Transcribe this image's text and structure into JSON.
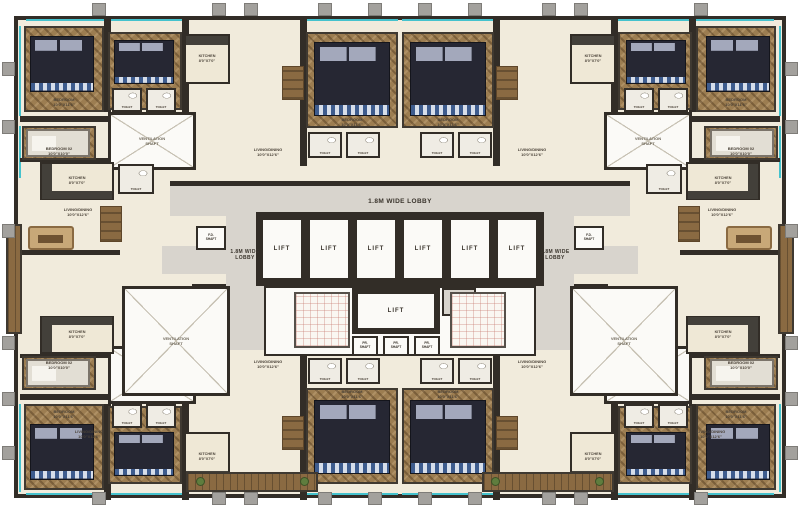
{
  "meta": {
    "type": "architectural-floor-plan",
    "description": "Residential tower typical floor plan with central lift core and apartments on all sides"
  },
  "palette": {
    "background": "#ffffff",
    "floor_cream": "#f1ebdc",
    "lobby_gray": "#d8d4cd",
    "wall_dark": "#322d27",
    "wood_brown": "#9c7d51",
    "bed_navy": "#262733",
    "window_cyan": "#45c2cd",
    "column_gray": "#a3a19d",
    "deck_brown": "#8a6a42"
  },
  "labels": {
    "lift": "LIFT",
    "lobby": "1.8M WIDE LOBBY",
    "fire": "FIRE\nLOBBY",
    "vent": "VENTILATION\nSHAFT",
    "bedroom": "BEDROOM\n10'0\"X11'6\"",
    "bedroom2": "BEDROOM 02\n10'0\"X10'0\"",
    "kitchen": "KITCHEN\n8'0\"X7'0\"",
    "toilet": "TOILET",
    "living": "LIVING/DINING\n10'0\"X12'6\"",
    "fh": "F.H.\nSHAFT",
    "fd": "F.D.\nSHAFT",
    "pr": "PR.\nSHAFT"
  },
  "symmetry": {
    "mirror_x": 400,
    "mirror_y": 258
  },
  "items": [
    {
      "n": "building-footprint",
      "k": "footprint",
      "x": 14,
      "y": 16,
      "w": 772,
      "h": 482
    },
    {
      "n": "window-line",
      "k": "cyan",
      "x": 26,
      "y": 19,
      "w": 78,
      "h": 2,
      "m": "x"
    },
    {
      "n": "window-line",
      "k": "cyan",
      "x": 108,
      "y": 19,
      "w": 74,
      "h": 2,
      "m": "x"
    },
    {
      "n": "window-line",
      "k": "cyan",
      "x": 306,
      "y": 19,
      "w": 92,
      "h": 2,
      "m": "x"
    },
    {
      "n": "window-line",
      "k": "cyan",
      "x": 26,
      "y": 493,
      "w": 78,
      "h": 2,
      "m": "x"
    },
    {
      "n": "window-line",
      "k": "cyan",
      "x": 108,
      "y": 493,
      "w": 74,
      "h": 2,
      "m": "x"
    },
    {
      "n": "window-line",
      "k": "cyan",
      "x": 306,
      "y": 493,
      "w": 92,
      "h": 2,
      "m": "x"
    },
    {
      "n": "window-line",
      "k": "cyan",
      "x": 19,
      "y": 26,
      "w": 2,
      "h": 90,
      "m": "x"
    },
    {
      "n": "window-line",
      "k": "cyan",
      "x": 19,
      "y": 126,
      "w": 2,
      "h": 52,
      "m": "x"
    },
    {
      "n": "window-line",
      "k": "cyan",
      "x": 19,
      "y": 224,
      "w": 2,
      "h": 108,
      "m": "x"
    },
    {
      "n": "window-line",
      "k": "cyan",
      "x": 19,
      "y": 404,
      "w": 2,
      "h": 88,
      "m": "x"
    },
    {
      "n": "lobby-corridor",
      "k": "lobby",
      "x": 170,
      "y": 186,
      "w": 460,
      "h": 30
    },
    {
      "n": "lobby-corridor-left",
      "k": "lobby",
      "x": 226,
      "y": 186,
      "w": 38,
      "h": 164
    },
    {
      "n": "lobby-corridor-right",
      "k": "lobby",
      "x": 536,
      "y": 186,
      "w": 38,
      "h": 164
    },
    {
      "n": "lobby-entry",
      "k": "lobby",
      "x": 162,
      "y": 246,
      "w": 64,
      "h": 28,
      "m": "x"
    },
    {
      "n": "wall",
      "k": "wall",
      "x": 170,
      "y": 181,
      "w": 460,
      "h": 5
    },
    {
      "n": "wall",
      "k": "wall",
      "x": 104,
      "y": 16,
      "w": 7,
      "h": 96,
      "m": "xy"
    },
    {
      "n": "wall",
      "k": "wall",
      "x": 182,
      "y": 16,
      "w": 7,
      "h": 100,
      "m": "xy"
    },
    {
      "n": "wall",
      "k": "wall",
      "x": 300,
      "y": 16,
      "w": 7,
      "h": 150,
      "m": "xy"
    },
    {
      "n": "wall",
      "k": "wall",
      "x": 20,
      "y": 116,
      "w": 160,
      "h": 6,
      "m": "xy"
    },
    {
      "n": "wall",
      "k": "wall",
      "x": 20,
      "y": 158,
      "w": 96,
      "h": 4,
      "m": "xy"
    },
    {
      "n": "wall",
      "k": "wall",
      "x": 20,
      "y": 250,
      "w": 100,
      "h": 5,
      "m": "x"
    },
    {
      "n": "core-hall",
      "k": "whiteroom",
      "x": 264,
      "y": 286,
      "w": 272,
      "h": 70
    },
    {
      "n": "lift-bank-walls",
      "k": "wallblock",
      "x": 256,
      "y": 212,
      "w": 288,
      "h": 74
    },
    {
      "n": "lift-room",
      "k": "liftcell",
      "x": 263,
      "y": 220,
      "w": 38,
      "h": 58,
      "l": "lift"
    },
    {
      "n": "lift-room",
      "k": "liftcell",
      "x": 310,
      "y": 220,
      "w": 38,
      "h": 58,
      "l": "lift"
    },
    {
      "n": "lift-room",
      "k": "liftcell",
      "x": 357,
      "y": 220,
      "w": 38,
      "h": 58,
      "l": "lift"
    },
    {
      "n": "lift-room",
      "k": "liftcell",
      "x": 404,
      "y": 220,
      "w": 38,
      "h": 58,
      "l": "lift"
    },
    {
      "n": "lift-room",
      "k": "liftcell",
      "x": 451,
      "y": 220,
      "w": 38,
      "h": 58,
      "l": "lift"
    },
    {
      "n": "lift-room",
      "k": "liftcell",
      "x": 498,
      "y": 220,
      "w": 38,
      "h": 58,
      "l": "lift"
    },
    {
      "n": "lift-center-walls",
      "k": "wallblock",
      "x": 352,
      "y": 288,
      "w": 88,
      "h": 46
    },
    {
      "n": "lift-room-center",
      "k": "liftcell",
      "x": 358,
      "y": 294,
      "w": 76,
      "h": 34,
      "l": "lift"
    },
    {
      "n": "fire-lobby",
      "k": "smallcell gray",
      "x": 442,
      "y": 288,
      "w": 34,
      "h": 28,
      "l": "fire"
    },
    {
      "n": "pressurization-shaft",
      "k": "smallcell",
      "x": 352,
      "y": 336,
      "w": 26,
      "h": 20,
      "l": "pr"
    },
    {
      "n": "pressurization-shaft",
      "k": "smallcell",
      "x": 383,
      "y": 336,
      "w": 26,
      "h": 20,
      "l": "pr"
    },
    {
      "n": "pressurization-shaft",
      "k": "smallcell",
      "x": 414,
      "y": 336,
      "w": 26,
      "h": 20,
      "l": "pr"
    },
    {
      "n": "staircase",
      "k": "stair",
      "x": 294,
      "y": 292,
      "w": 56,
      "h": 56,
      "m": "x"
    },
    {
      "n": "fd-shaft",
      "k": "smallcell",
      "x": 196,
      "y": 226,
      "w": 30,
      "h": 24,
      "l": "fd",
      "m": "x"
    },
    {
      "n": "fh-shaft",
      "k": "smallcell",
      "x": 192,
      "y": 284,
      "w": 34,
      "h": 26,
      "l": "fh",
      "m": "x"
    },
    {
      "n": "ventilation-shaft",
      "k": "shaft",
      "x": 108,
      "y": 112,
      "w": 88,
      "h": 58,
      "l": "vent",
      "m": "xy"
    },
    {
      "n": "ventilation-shaft",
      "k": "shaft",
      "x": 122,
      "y": 286,
      "w": 108,
      "h": 110,
      "l": "vent",
      "m": "x"
    },
    {
      "n": "wood-floor",
      "k": "wood",
      "x": 24,
      "y": 26,
      "w": 80,
      "h": 86,
      "m": "xy"
    },
    {
      "n": "wood-floor",
      "k": "wood",
      "x": 108,
      "y": 32,
      "w": 74,
      "h": 78,
      "m": "xy"
    },
    {
      "n": "wood-floor",
      "k": "wood",
      "x": 306,
      "y": 32,
      "w": 92,
      "h": 96,
      "m": "xy"
    },
    {
      "n": "wood-floor",
      "k": "wood",
      "x": 22,
      "y": 126,
      "w": 74,
      "h": 34,
      "m": "xy"
    },
    {
      "n": "kitchen",
      "k": "room",
      "x": 184,
      "y": 34,
      "w": 46,
      "h": 50,
      "l": "kitchen",
      "m": "xy"
    },
    {
      "n": "kitchen-counter",
      "k": "counter",
      "x": 186,
      "y": 36,
      "w": 42,
      "h": 9,
      "m": "xy"
    },
    {
      "n": "kitchen",
      "k": "room",
      "x": 40,
      "y": 162,
      "w": 74,
      "h": 38,
      "l": "kitchen",
      "m": "xy"
    },
    {
      "n": "kitchen-counter",
      "k": "counter",
      "x": 42,
      "y": 164,
      "w": 10,
      "h": 34,
      "m": "xy"
    },
    {
      "n": "kitchen-counter",
      "k": "counter",
      "x": 42,
      "y": 191,
      "w": 70,
      "h": 8,
      "m": "xy"
    },
    {
      "n": "double-bed",
      "k": "bed",
      "x": 30,
      "y": 36,
      "w": 64,
      "h": 56,
      "m": "xy"
    },
    {
      "n": "double-bed",
      "k": "bed",
      "x": 114,
      "y": 40,
      "w": 60,
      "h": 44,
      "m": "xy"
    },
    {
      "n": "double-bed",
      "k": "bed",
      "x": 314,
      "y": 42,
      "w": 76,
      "h": 74,
      "m": "xy"
    },
    {
      "n": "double-bed-light",
      "k": "bedlight",
      "x": 26,
      "y": 129,
      "w": 64,
      "h": 28,
      "m": "xy"
    },
    {
      "n": "toilet-room",
      "k": "toilet",
      "x": 112,
      "y": 88,
      "w": 30,
      "h": 24,
      "l": "toilet",
      "m": "xy"
    },
    {
      "n": "toilet-room",
      "k": "toilet",
      "x": 146,
      "y": 88,
      "w": 30,
      "h": 24,
      "l": "toilet",
      "m": "xy"
    },
    {
      "n": "toilet-room",
      "k": "toilet",
      "x": 308,
      "y": 132,
      "w": 34,
      "h": 26,
      "l": "toilet",
      "m": "xy"
    },
    {
      "n": "toilet-room",
      "k": "toilet",
      "x": 346,
      "y": 132,
      "w": 34,
      "h": 26,
      "l": "toilet",
      "m": "xy"
    },
    {
      "n": "toilet-room",
      "k": "toilet",
      "x": 118,
      "y": 164,
      "w": 36,
      "h": 30,
      "l": "toilet",
      "m": "x"
    },
    {
      "n": "sofa",
      "k": "sofa",
      "x": 28,
      "y": 226,
      "w": 46,
      "h": 24,
      "m": "x"
    },
    {
      "n": "dining-table",
      "k": "table",
      "x": 100,
      "y": 206,
      "w": 22,
      "h": 36,
      "m": "x"
    },
    {
      "n": "dining-table",
      "k": "table",
      "x": 282,
      "y": 66,
      "w": 22,
      "h": 34,
      "m": "xy"
    },
    {
      "n": "balcony-deck",
      "k": "deck",
      "x": 6,
      "y": 224,
      "w": 16,
      "h": 110,
      "m": "x"
    },
    {
      "n": "balcony-deck",
      "k": "deck",
      "x": 186,
      "y": 472,
      "w": 132,
      "h": 20,
      "m": "x"
    },
    {
      "n": "planter",
      "k": "planter",
      "x": 196,
      "y": 477,
      "w": 9,
      "h": 9,
      "m": "x"
    },
    {
      "n": "planter",
      "k": "planter",
      "x": 300,
      "y": 477,
      "w": 9,
      "h": 9,
      "m": "x"
    },
    {
      "n": "column-stub",
      "k": "stub",
      "x": 92,
      "y": 3,
      "w": 14,
      "h": 13,
      "m": "x"
    },
    {
      "n": "column-stub",
      "k": "stub",
      "x": 212,
      "y": 3,
      "w": 14,
      "h": 13,
      "m": "x"
    },
    {
      "n": "column-stub",
      "k": "stub",
      "x": 244,
      "y": 3,
      "w": 14,
      "h": 13,
      "m": "x"
    },
    {
      "n": "column-stub",
      "k": "stub",
      "x": 318,
      "y": 3,
      "w": 14,
      "h": 13,
      "m": "x"
    },
    {
      "n": "column-stub",
      "k": "stub",
      "x": 368,
      "y": 3,
      "w": 14,
      "h": 13,
      "m": "x"
    },
    {
      "n": "column-stub",
      "k": "stub",
      "x": 92,
      "y": 492,
      "w": 14,
      "h": 13,
      "m": "x"
    },
    {
      "n": "column-stub",
      "k": "stub",
      "x": 212,
      "y": 492,
      "w": 14,
      "h": 13,
      "m": "x"
    },
    {
      "n": "column-stub",
      "k": "stub",
      "x": 244,
      "y": 492,
      "w": 14,
      "h": 13,
      "m": "x"
    },
    {
      "n": "column-stub",
      "k": "stub",
      "x": 318,
      "y": 492,
      "w": 14,
      "h": 13,
      "m": "x"
    },
    {
      "n": "column-stub",
      "k": "stub",
      "x": 368,
      "y": 492,
      "w": 14,
      "h": 13,
      "m": "x"
    },
    {
      "n": "column-stub",
      "k": "stub",
      "x": 2,
      "y": 62,
      "w": 13,
      "h": 14,
      "m": "x"
    },
    {
      "n": "column-stub",
      "k": "stub",
      "x": 2,
      "y": 120,
      "w": 13,
      "h": 14,
      "m": "x"
    },
    {
      "n": "column-stub",
      "k": "stub",
      "x": 2,
      "y": 224,
      "w": 13,
      "h": 14,
      "m": "x"
    },
    {
      "n": "column-stub",
      "k": "stub",
      "x": 2,
      "y": 336,
      "w": 13,
      "h": 14,
      "m": "x"
    },
    {
      "n": "column-stub",
      "k": "stub",
      "x": 2,
      "y": 392,
      "w": 13,
      "h": 14,
      "m": "x"
    },
    {
      "n": "column-stub",
      "k": "stub",
      "x": 2,
      "y": 446,
      "w": 13,
      "h": 14,
      "m": "x"
    },
    {
      "n": "lobby-label",
      "k": "lobbylabel",
      "x": 330,
      "y": 194,
      "w": 140,
      "h": 14,
      "l": "lobby"
    },
    {
      "n": "lobby-label",
      "k": "lobbylabel small",
      "x": 221,
      "y": 244,
      "w": 48,
      "h": 22,
      "l": "lobby",
      "m": "x"
    },
    {
      "n": "room-label",
      "k": "rlabel",
      "x": 28,
      "y": 96,
      "w": 72,
      "h": 12,
      "l": "bedroom",
      "m": "xy"
    },
    {
      "n": "room-label",
      "k": "rlabel",
      "x": 314,
      "y": 117,
      "w": 76,
      "h": 10,
      "l": "bedroom",
      "m": "xy"
    },
    {
      "n": "room-label",
      "k": "rlabel",
      "x": 24,
      "y": 146,
      "w": 70,
      "h": 10,
      "l": "bedroom2",
      "m": "xy"
    },
    {
      "n": "room-label",
      "k": "rlabel",
      "x": 50,
      "y": 206,
      "w": 56,
      "h": 12,
      "l": "living",
      "m": "x"
    },
    {
      "n": "room-label",
      "k": "rlabel",
      "x": 236,
      "y": 146,
      "w": 64,
      "h": 12,
      "l": "living",
      "m": "xy"
    },
    {
      "n": "room-label",
      "k": "rlabel",
      "x": 56,
      "y": 428,
      "w": 66,
      "h": 12,
      "l": "living",
      "m": "x"
    }
  ]
}
